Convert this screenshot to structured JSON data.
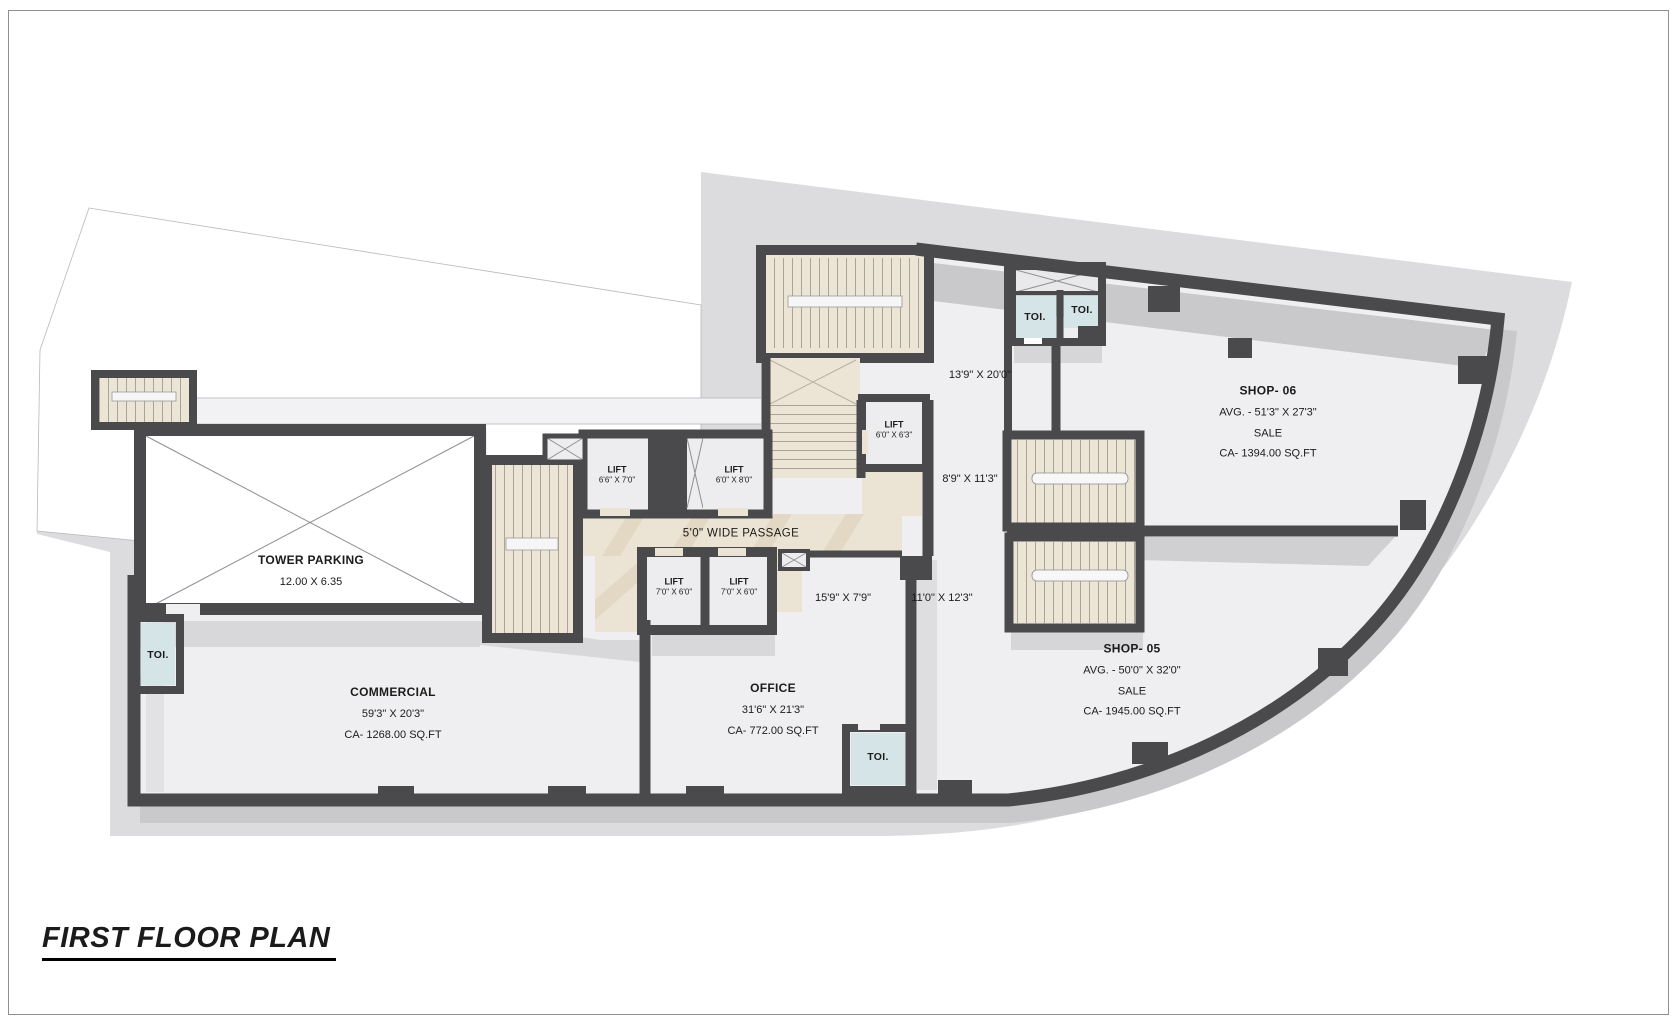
{
  "title": "FIRST FLOOR PLAN",
  "rooms": {
    "tower_parking": {
      "name": "TOWER PARKING",
      "dims": "12.00 X 6.35"
    },
    "commercial": {
      "name": "COMMERCIAL",
      "dims": "59'3\" X 20'3\"",
      "area": "CA- 1268.00 SQ.FT"
    },
    "office": {
      "name": "OFFICE",
      "dims": "31'6\" X 21'3\"",
      "area": "CA- 772.00 SQ.FT"
    },
    "shop_06": {
      "name": "SHOP- 06",
      "avg": "AVG. - 51'3\" X 27'3\"",
      "sale": "SALE",
      "area": "CA- 1394.00 SQ.FT"
    },
    "shop_05": {
      "name": "SHOP- 05",
      "avg": "AVG. - 50'0\" X 32'0\"",
      "sale": "SALE",
      "area": "CA- 1945.00 SQ.FT"
    }
  },
  "passage": {
    "label": "5'0\" WIDE PASSAGE"
  },
  "lifts": [
    {
      "label": "LIFT",
      "dims": "6'6\" X 7'0\""
    },
    {
      "label": "LIFT",
      "dims": "6'0\" X 8'0\""
    },
    {
      "label": "LIFT",
      "dims": "7'0\" X 6'0\""
    },
    {
      "label": "LIFT",
      "dims": "7'0\" X 6'0\""
    },
    {
      "label": "LIFT",
      "dims": "6'0\" X 6'3\""
    }
  ],
  "open_areas": [
    {
      "dims": "13'9\" X 20'0\""
    },
    {
      "dims": "8'9\" X 11'3\""
    },
    {
      "dims": "11'0\" X 12'3\""
    },
    {
      "dims": "15'9\" X 7'9\""
    }
  ],
  "toilets": [
    {
      "label": "TOI."
    },
    {
      "label": "TOI."
    },
    {
      "label": "TOI."
    },
    {
      "label": "TOI."
    }
  ],
  "colors": {
    "wall": "#4a4a4d",
    "site": "#dcdcdf",
    "floor": "#efeff1",
    "passage": "#ebe3d3",
    "toilet": "#d5e4e6",
    "shadow": "#c9c9cc"
  }
}
